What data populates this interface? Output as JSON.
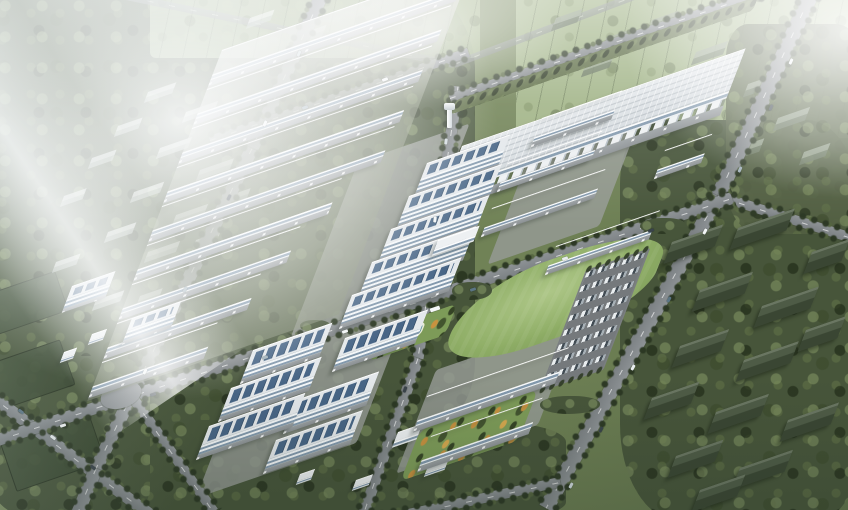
{
  "scene": {
    "title": "Hazy aerial rendering of a master-planned industrial park campus surrounded by farmland, forest and village houses",
    "type": "architectural-aerial-render",
    "environment": {
      "surroundings": "farmland with tree lines to the north, dense woodland and existing village gable-roof houses east and southwest",
      "lighting": "overcast hazy daylight with strong white bloom in the north-west corner",
      "accents": "autumn yellow trees along the southern campus streets and gardens"
    },
    "areas": [
      {
        "id": "warehouse-rows-west",
        "label": "Stepped rows of long gable warehouses",
        "count": 9
      },
      {
        "id": "big-warehouse-northeast",
        "label": "Large logistics warehouse with gridded roof",
        "count": 1
      },
      {
        "id": "mid-warehouses-center",
        "label": "Mid-size workshop buildings",
        "count": 5
      },
      {
        "id": "office-terrace-center",
        "label": "Terraced multi-storey offices with rooftop solar panels",
        "count": 5
      },
      {
        "id": "south-campus",
        "label": "R&D / office blocks with large rooftop solar arrays",
        "count": 6
      },
      {
        "id": "twin-warehouses-southeast",
        "label": "Twin warehouses south of the lawn",
        "count": 2
      },
      {
        "id": "lawn-east",
        "label": "Open green lawn"
      },
      {
        "id": "parking-lot-east",
        "label": "Surface parking lot filled with cars",
        "rows": 8
      },
      {
        "id": "pond-garden",
        "label": "Landscaped garden with blue pond"
      },
      {
        "id": "water-tower",
        "label": "White water tower at central crossroads"
      },
      {
        "id": "village-east",
        "label": "Existing dark-roof village houses in woodland"
      },
      {
        "id": "village-northwest",
        "label": "Hazy existing village under fog"
      },
      {
        "id": "farmland-north",
        "label": "Hazy farmland, hedgerows and rural roads"
      },
      {
        "id": "roads",
        "label": "Tree-lined arterial roads crossing the park",
        "count": 7
      }
    ],
    "palette": {
      "groundLight": "#94a573",
      "ground": "#75875a",
      "forest": "#47553a",
      "forestDark": "#323e28",
      "field": "#9fb284",
      "lawn": "#8fae66",
      "roadFill": "#7b8083",
      "roadLight": "#8d9295",
      "roofLight": "#dfe4e8",
      "facade": "#f5f7f8",
      "glass": "#8399ad",
      "solar": "#3a5a7d",
      "water": "#4e93b0",
      "ghostLight": "#e9eeeb",
      "ghostDark": "#aeb9b0",
      "village": "#49553f",
      "apron": "#94999c",
      "haze": "#ffffff"
    }
  }
}
